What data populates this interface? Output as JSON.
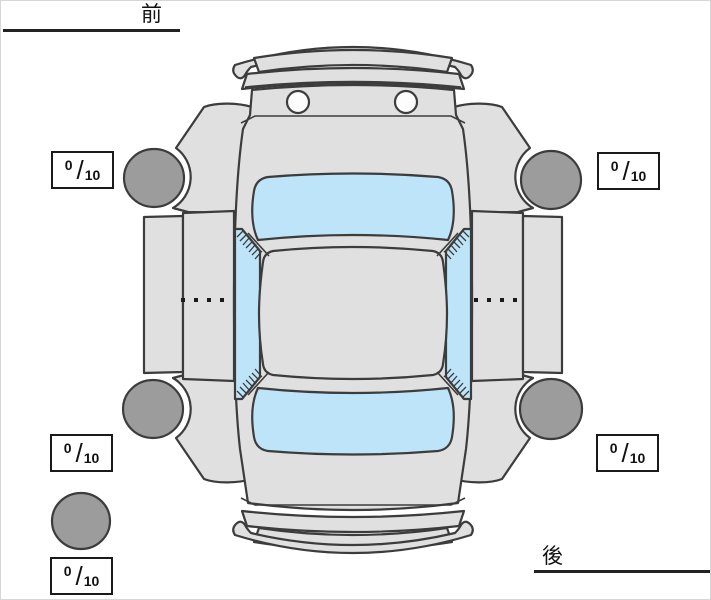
{
  "title": "car-tire-condition-diagram",
  "labels": {
    "front": "前",
    "rear": "後"
  },
  "fraction_separator": "/",
  "tires": {
    "front_left": {
      "score": "0",
      "max": "10"
    },
    "front_right": {
      "score": "0",
      "max": "10"
    },
    "rear_left": {
      "score": "0",
      "max": "10"
    },
    "rear_right": {
      "score": "0",
      "max": "10"
    },
    "spare": {
      "score": "0",
      "max": "10"
    }
  },
  "colors": {
    "body": "#e0e0e0",
    "window": "#bde4f8",
    "tire": "#9c9c9c",
    "outline": "#3c3c3c",
    "line": "#1a1a1a",
    "box-bg": "#ffffff",
    "headlight": "#fdfdfd"
  }
}
